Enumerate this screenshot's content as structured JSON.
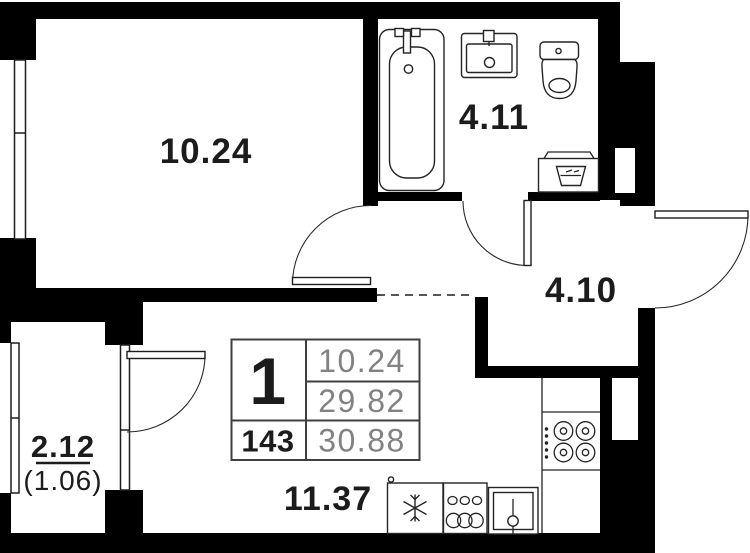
{
  "floor_plan": {
    "room_labels": {
      "living_room": "10.24",
      "bathroom": "4.11",
      "hallway": "4.10",
      "kitchen": "11.37",
      "balcony": "2.12",
      "balcony_coefficient": "(1.06)"
    },
    "info_table": {
      "room_count": "1",
      "apartment_number": "143",
      "value_top": "10.24",
      "value_middle": "29.82",
      "value_bottom": "30.88"
    },
    "fixtures": [
      "bathtub",
      "bathroom-sink",
      "toilet",
      "washing-machine",
      "stove",
      "kitchen-counter",
      "fridge",
      "cookware",
      "kitchen-sink"
    ],
    "colors": {
      "wall": "#000000",
      "label_text": "#1c1c1c",
      "table_muted_text": "#828282",
      "line": "#2a2a2a"
    }
  }
}
